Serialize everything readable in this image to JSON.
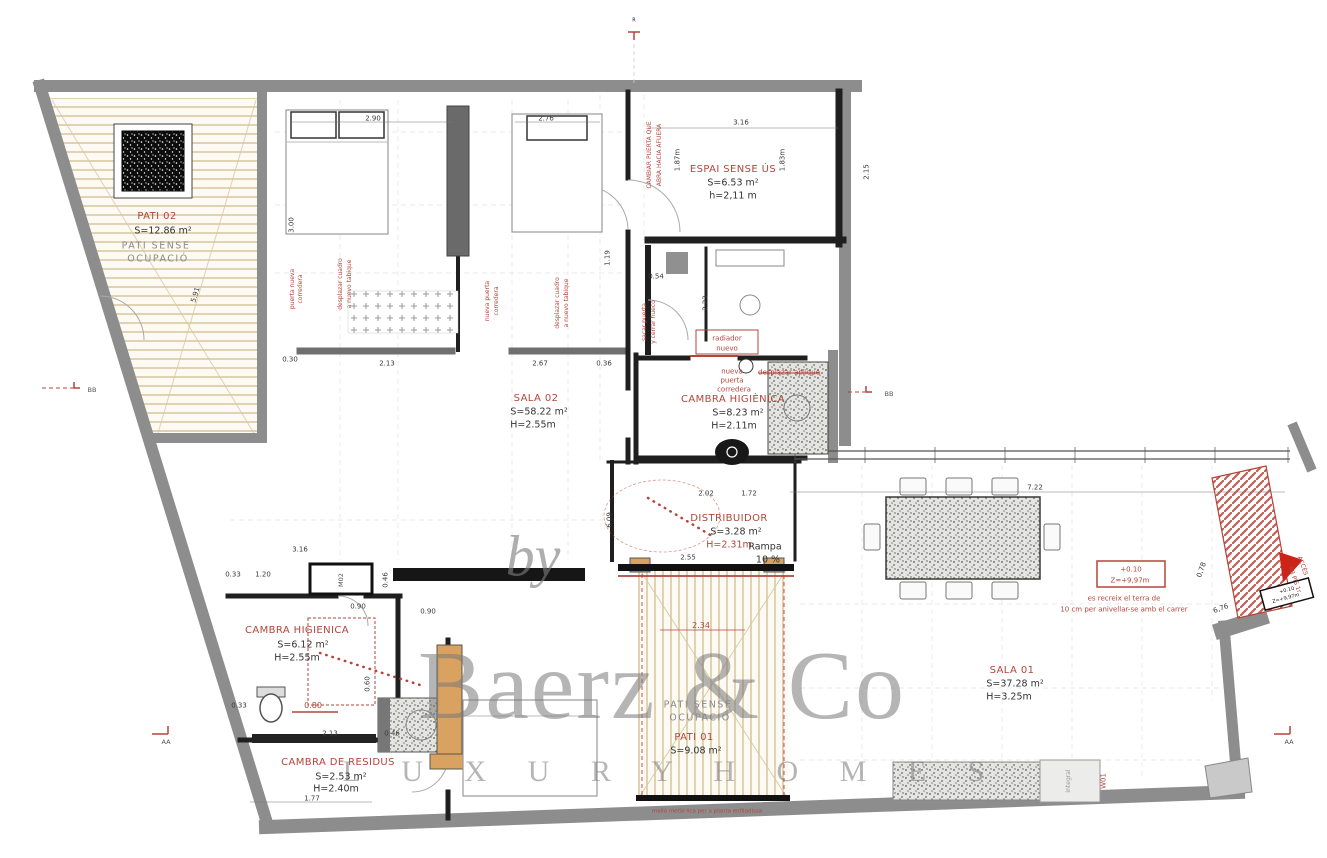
{
  "watermark": {
    "by": "by",
    "brand": "Baerz & Co",
    "tagline": "L U X U R Y   H O M E S"
  },
  "colors": {
    "annotation_red": "#b5443b",
    "wall_gray": "#8d8d8d",
    "patio_tan": "#d9c8a2",
    "furniture_tan": "#d9a260",
    "watermark_gray": "#787878"
  },
  "rooms": [
    {
      "name": "PATI 02",
      "area": "S=12.86 m²",
      "note": "PATI SENSE OCUPACIÓ"
    },
    {
      "name": "ESPAI SENSE ÚS",
      "area": "S=6.53 m²",
      "height": "h=2,11 m"
    },
    {
      "name": "SALA 02",
      "area": "S=58.22 m²",
      "height": "H=2.55m"
    },
    {
      "name": "CAMBRA HIGIÈNICA",
      "area": "S=8.23 m²",
      "height": "H=2.11m"
    },
    {
      "name": "DISTRIBUIDOR",
      "area": "S=3.28 m²",
      "height": "H=2.31m"
    },
    {
      "name": "CAMBRA HIGIENICA",
      "area": "S=6.12 m²",
      "height": "H=2.55m"
    },
    {
      "name": "CAMBRA DE RESIDUS",
      "area": "S=2.53 m²",
      "height": "H=2.40m"
    },
    {
      "name": "PATI 01",
      "area": "S=9.08 m²",
      "note": "PATI SENSE OCUPACIÓ"
    },
    {
      "name": "SALA 01",
      "area": "S=37.28 m²",
      "height": "H=3.25m"
    }
  ],
  "texts": [
    {
      "t": "PATI 02",
      "x": 157,
      "y": 217,
      "c": "rt",
      "n": "room-title-pati-02"
    },
    {
      "t": "S=12.86 m²",
      "x": 163,
      "y": 231,
      "c": "rm",
      "n": "room-area-pati-02"
    },
    {
      "t": "PATI  SENSE",
      "x": 156,
      "y": 246,
      "c": "gm",
      "n": "room-note"
    },
    {
      "t": "OCUPACIÓ",
      "x": 158,
      "y": 259,
      "c": "gm",
      "n": "room-note"
    },
    {
      "t": "ESPAI SENSE ÚS",
      "x": 733,
      "y": 170,
      "c": "rt",
      "n": "room-title-espai-sense-us"
    },
    {
      "t": "S=6.53 m²",
      "x": 733,
      "y": 183,
      "c": "rm",
      "n": "room-area"
    },
    {
      "t": "h=2,11 m",
      "x": 733,
      "y": 196,
      "c": "rm",
      "n": "room-height"
    },
    {
      "t": "SALA 02",
      "x": 536,
      "y": 399,
      "c": "rt",
      "n": "room-title-sala-02"
    },
    {
      "t": "S=58.22 m²",
      "x": 539,
      "y": 412,
      "c": "rm",
      "n": "room-area"
    },
    {
      "t": "H=2.55m",
      "x": 533,
      "y": 425,
      "c": "rm",
      "n": "room-height"
    },
    {
      "t": "CAMBRA HIGIÈNICA",
      "x": 733,
      "y": 400,
      "c": "rt",
      "n": "room-title-cambra-higienica"
    },
    {
      "t": "S=8.23 m²",
      "x": 738,
      "y": 413,
      "c": "rm",
      "n": "room-area"
    },
    {
      "t": "H=2.11m",
      "x": 734,
      "y": 426,
      "c": "rm",
      "n": "room-height"
    },
    {
      "t": "DISTRIBUIDOR",
      "x": 729,
      "y": 519,
      "c": "rt",
      "n": "room-title-distribuidor"
    },
    {
      "t": "S=3.28 m²",
      "x": 736,
      "y": 532,
      "c": "rm",
      "n": "room-area"
    },
    {
      "t": "H=2.31m",
      "x": 729,
      "y": 545,
      "c": "rmr",
      "n": "room-height"
    },
    {
      "t": "Rampa",
      "x": 765,
      "y": 547,
      "c": "rm",
      "n": "ramp-label"
    },
    {
      "t": "10 %",
      "x": 768,
      "y": 560,
      "c": "rm",
      "n": "ramp-slope"
    },
    {
      "t": "CAMBRA HIGIENICA",
      "x": 297,
      "y": 631,
      "c": "rt",
      "n": "room-title-cambra-higienica-2"
    },
    {
      "t": "S=6.12 m²",
      "x": 303,
      "y": 645,
      "c": "rm",
      "n": "room-area"
    },
    {
      "t": "H=2.55m",
      "x": 297,
      "y": 658,
      "c": "rm",
      "n": "room-height"
    },
    {
      "t": "CAMBRA DE RESIDUS",
      "x": 338,
      "y": 763,
      "c": "rt",
      "n": "room-title-cambra-de-residus"
    },
    {
      "t": "S=2.53 m²",
      "x": 341,
      "y": 777,
      "c": "rm",
      "n": "room-area"
    },
    {
      "t": "H=2.40m",
      "x": 336,
      "y": 789,
      "c": "rm",
      "n": "room-height"
    },
    {
      "t": "PATI  SENSE",
      "x": 698,
      "y": 705,
      "c": "gm",
      "n": "room-note"
    },
    {
      "t": "OCUPACIÓ",
      "x": 700,
      "y": 718,
      "c": "gm",
      "n": "room-note"
    },
    {
      "t": "PATI 01",
      "x": 694,
      "y": 738,
      "c": "rt",
      "n": "room-title-pati-01"
    },
    {
      "t": "S=9.08 m²",
      "x": 696,
      "y": 751,
      "c": "rm",
      "n": "room-area"
    },
    {
      "t": "SALA 01",
      "x": 1012,
      "y": 671,
      "c": "rt",
      "n": "room-title-sala-01"
    },
    {
      "t": "S=37.28 m²",
      "x": 1015,
      "y": 684,
      "c": "rm",
      "n": "room-area"
    },
    {
      "t": "H=3.25m",
      "x": 1009,
      "y": 697,
      "c": "rm",
      "n": "room-height"
    },
    {
      "t": "radiador",
      "x": 727,
      "y": 339,
      "c": "ann",
      "n": "note-radiator"
    },
    {
      "t": "nuevo",
      "x": 727,
      "y": 349,
      "c": "ann",
      "n": "note-radiator"
    },
    {
      "t": "nueva",
      "x": 732,
      "y": 372,
      "c": "ann",
      "n": "note-new-door"
    },
    {
      "t": "puerta",
      "x": 732,
      "y": 381,
      "c": "ann",
      "n": "note-new-door"
    },
    {
      "t": "corredera",
      "x": 734,
      "y": 390,
      "c": "ann",
      "n": "note-new-door"
    },
    {
      "t": "desplazar aplique",
      "x": 789,
      "y": 373,
      "c": "ann strike",
      "n": "note-move-light"
    },
    {
      "t": "CAMBIAR PUERTA QUE",
      "x": 650,
      "y": 155,
      "r": -90,
      "c": "a6",
      "n": "note-change-door"
    },
    {
      "t": "ABRA HACIA AFUERA",
      "x": 660,
      "y": 155,
      "r": -90,
      "c": "a6",
      "n": "note-change-door"
    },
    {
      "t": "puerta nueva",
      "x": 293,
      "y": 289,
      "r": -90,
      "c": "a6",
      "n": "note-new-door"
    },
    {
      "t": "corredera",
      "x": 301,
      "y": 289,
      "r": -90,
      "c": "a6",
      "n": "note-new-door"
    },
    {
      "t": "desplazar cuadro",
      "x": 341,
      "y": 284,
      "r": -90,
      "c": "a6",
      "n": "note-move-panel"
    },
    {
      "t": "a nuevo tabique",
      "x": 350,
      "y": 284,
      "r": -90,
      "c": "a6",
      "n": "note-move-panel"
    },
    {
      "t": "nueva puerta",
      "x": 488,
      "y": 301,
      "r": -90,
      "c": "a6",
      "n": "note-new-door"
    },
    {
      "t": "corredera",
      "x": 497,
      "y": 301,
      "r": -90,
      "c": "a6",
      "n": "note-new-door"
    },
    {
      "t": "desplazar cuadro",
      "x": 558,
      "y": 303,
      "r": -90,
      "c": "a6",
      "n": "note-move-panel"
    },
    {
      "t": "a nuevo tabique",
      "x": 567,
      "y": 303,
      "r": -90,
      "c": "a6",
      "n": "note-move-panel"
    },
    {
      "t": "sacar puerta",
      "x": 645,
      "y": 322,
      "r": -90,
      "c": "a6",
      "n": "note-remove-door"
    },
    {
      "t": "y cerrar hueco",
      "x": 654,
      "y": 322,
      "r": -90,
      "c": "a6",
      "n": "note-remove-door"
    },
    {
      "t": "es recreix el terra de",
      "x": 1124,
      "y": 599,
      "c": "ann",
      "n": "note-floor-raise"
    },
    {
      "t": "10 cm per anivellar-se amb el carrer",
      "x": 1124,
      "y": 610,
      "c": "ann",
      "n": "note-floor-raise"
    },
    {
      "t": "+0.10",
      "x": 1131,
      "y": 570,
      "c": "ann",
      "n": "level-mark"
    },
    {
      "t": "Z=+9,97m",
      "x": 1130,
      "y": 581,
      "c": "ann",
      "n": "level-mark"
    },
    {
      "t": "+0.10",
      "x": 1287,
      "y": 591,
      "r": -15,
      "c": "d5",
      "n": "level-mark"
    },
    {
      "t": "Z=+9,97m",
      "x": 1286,
      "y": 599,
      "r": -15,
      "c": "d5",
      "n": "level-mark"
    },
    {
      "t": "ACCÉS",
      "x": 1302,
      "y": 566,
      "r": 70,
      "c": "a6",
      "n": "access-label"
    },
    {
      "t": "PB PIS 1r",
      "x": 1294,
      "y": 580,
      "r": 70,
      "c": "a6",
      "n": "access-label"
    },
    {
      "t": "W01",
      "x": 1104,
      "y": 781,
      "r": -90,
      "c": "ann",
      "n": "code-w01"
    },
    {
      "t": "M02",
      "x": 341,
      "y": 580,
      "r": -90,
      "c": "d6",
      "n": "code-m02"
    },
    {
      "t": "integral",
      "x": 1069,
      "y": 781,
      "r": -90,
      "c": "d6g",
      "n": "code-integral"
    },
    {
      "t": "malla metàl·lica per a planta enfiladissa",
      "x": 707,
      "y": 812,
      "c": "a5",
      "n": "note-mesh"
    },
    {
      "t": "0.80",
      "x": 313,
      "y": 706,
      "c": "dimr",
      "n": "dim-red"
    },
    {
      "t": "2.34",
      "x": 701,
      "y": 626,
      "c": "dimr",
      "n": "dim-red"
    },
    {
      "t": "BB",
      "x": 92,
      "y": 390,
      "c": "d6",
      "n": "section-mark-bb"
    },
    {
      "t": "BB",
      "x": 889,
      "y": 394,
      "c": "d6",
      "n": "section-mark-bb"
    },
    {
      "t": "AA",
      "x": 166,
      "y": 742,
      "c": "d6",
      "n": "section-mark-aa"
    },
    {
      "t": "AA",
      "x": 1289,
      "y": 742,
      "c": "d6",
      "n": "section-mark-aa"
    },
    {
      "t": "R",
      "x": 634,
      "y": 21,
      "c": "d5",
      "n": "ref-mark"
    },
    {
      "t": "2.90",
      "x": 373,
      "y": 119,
      "c": "dim",
      "n": "dim"
    },
    {
      "t": "2.76",
      "x": 546,
      "y": 119,
      "c": "dim",
      "n": "dim"
    },
    {
      "t": "3.16",
      "x": 741,
      "y": 123,
      "c": "dim",
      "n": "dim"
    },
    {
      "t": "2.15",
      "x": 867,
      "y": 172,
      "r": -90,
      "c": "dim",
      "n": "dim"
    },
    {
      "t": "3.00",
      "x": 292,
      "y": 225,
      "r": -90,
      "c": "dim",
      "n": "dim"
    },
    {
      "t": "1.19",
      "x": 608,
      "y": 258,
      "r": -90,
      "c": "dim",
      "n": "dim"
    },
    {
      "t": "0.54",
      "x": 656,
      "y": 277,
      "c": "dim",
      "n": "dim"
    },
    {
      "t": "2.23",
      "x": 706,
      "y": 303,
      "r": -90,
      "c": "dim",
      "n": "dim"
    },
    {
      "t": "1.87m",
      "x": 678,
      "y": 160,
      "r": -90,
      "c": "dim",
      "n": "dim"
    },
    {
      "t": "1.83m",
      "x": 783,
      "y": 160,
      "r": -90,
      "c": "dim",
      "n": "dim"
    },
    {
      "t": "0.30",
      "x": 290,
      "y": 360,
      "c": "dim",
      "n": "dim"
    },
    {
      "t": "2.13",
      "x": 387,
      "y": 364,
      "c": "dim",
      "n": "dim"
    },
    {
      "t": "2.67",
      "x": 540,
      "y": 364,
      "c": "dim",
      "n": "dim"
    },
    {
      "t": "0.36",
      "x": 604,
      "y": 364,
      "c": "dim",
      "n": "dim"
    },
    {
      "t": "5.91",
      "x": 196,
      "y": 295,
      "r": -73,
      "c": "dim",
      "n": "dim"
    },
    {
      "t": "6.09",
      "x": 610,
      "y": 520,
      "r": -90,
      "c": "dim",
      "n": "dim"
    },
    {
      "t": "2.02",
      "x": 706,
      "y": 494,
      "c": "dim",
      "n": "dim"
    },
    {
      "t": "1.72",
      "x": 749,
      "y": 494,
      "c": "dim",
      "n": "dim"
    },
    {
      "t": "2.55",
      "x": 688,
      "y": 558,
      "c": "dim",
      "n": "dim"
    },
    {
      "t": "3.16",
      "x": 300,
      "y": 550,
      "c": "dim",
      "n": "dim"
    },
    {
      "t": "0.33",
      "x": 233,
      "y": 575,
      "c": "dim",
      "n": "dim"
    },
    {
      "t": "1.20",
      "x": 263,
      "y": 575,
      "c": "dim",
      "n": "dim"
    },
    {
      "t": "0.46",
      "x": 386,
      "y": 580,
      "r": -90,
      "c": "dim",
      "n": "dim"
    },
    {
      "t": "0.90",
      "x": 428,
      "y": 612,
      "c": "dim",
      "n": "dim"
    },
    {
      "t": "0.90",
      "x": 358,
      "y": 607,
      "c": "dim",
      "n": "dim"
    },
    {
      "t": "0.60",
      "x": 368,
      "y": 684,
      "r": -90,
      "c": "dim",
      "n": "dim"
    },
    {
      "t": "0.33",
      "x": 239,
      "y": 706,
      "c": "dim",
      "n": "dim"
    },
    {
      "t": "2.13",
      "x": 330,
      "y": 734,
      "c": "dim",
      "n": "dim"
    },
    {
      "t": "0.46",
      "x": 392,
      "y": 734,
      "c": "dim",
      "n": "dim"
    },
    {
      "t": "1.77",
      "x": 312,
      "y": 799,
      "c": "dim",
      "n": "dim"
    },
    {
      "t": "7.22",
      "x": 1035,
      "y": 488,
      "c": "dim",
      "n": "dim"
    },
    {
      "t": "6,76",
      "x": 1221,
      "y": 609,
      "r": -20,
      "c": "dim",
      "n": "dim"
    },
    {
      "t": "0,78",
      "x": 1202,
      "y": 570,
      "r": -70,
      "c": "dim",
      "n": "dim"
    }
  ]
}
